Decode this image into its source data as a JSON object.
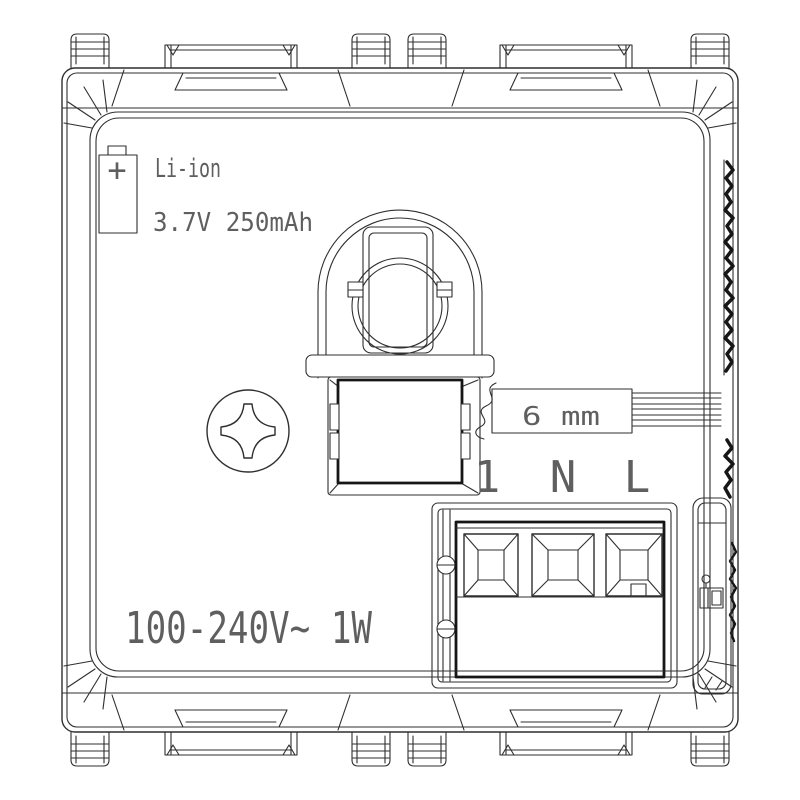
{
  "drawing": {
    "battery": {
      "type_label": "Li-ion",
      "rating_label": "3.7V 250mAh",
      "polarity": "+"
    },
    "wire_strip": {
      "length_label": "6 mm"
    },
    "terminals": {
      "labels": [
        "1",
        "N",
        "L"
      ]
    },
    "power_rating": "100-240V~ 1W",
    "colors": {
      "line": "#2f2f2f",
      "dark_line": "#161616",
      "text": "#5f5f5f",
      "background": "#ffffff"
    }
  }
}
